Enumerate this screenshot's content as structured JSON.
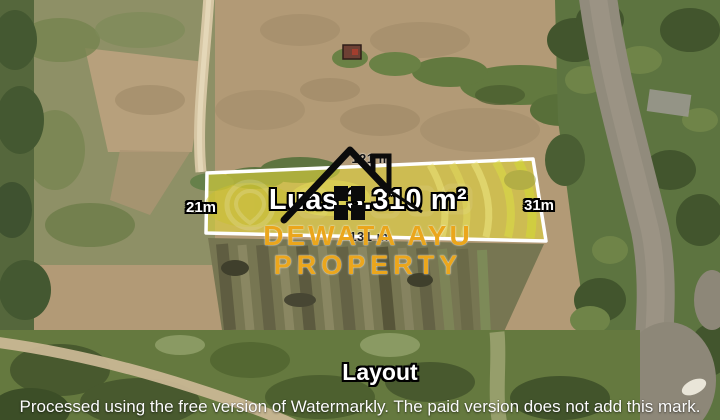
{
  "scene": {
    "type": "aerial-drone-photo-of-land",
    "caption": "Layout"
  },
  "listing": {
    "area_label": "Luas 3.310 m²",
    "dimensions": {
      "left": "21m",
      "right": "31m",
      "top": "121 m",
      "bottom": "131 m"
    },
    "plot_fill_color": "#ddd23c",
    "plot_border_color": "#ffffff",
    "house_icon": "house-icon"
  },
  "branding": {
    "name_line1": "DEWATA AYU",
    "name_line2": "PROPERTY",
    "color": "#eba61c"
  },
  "watermark": {
    "bar_text": "Processed using the free version of Watermarkly. The paid version does not add this mark.",
    "faint_logo": "location-pin-icon"
  }
}
